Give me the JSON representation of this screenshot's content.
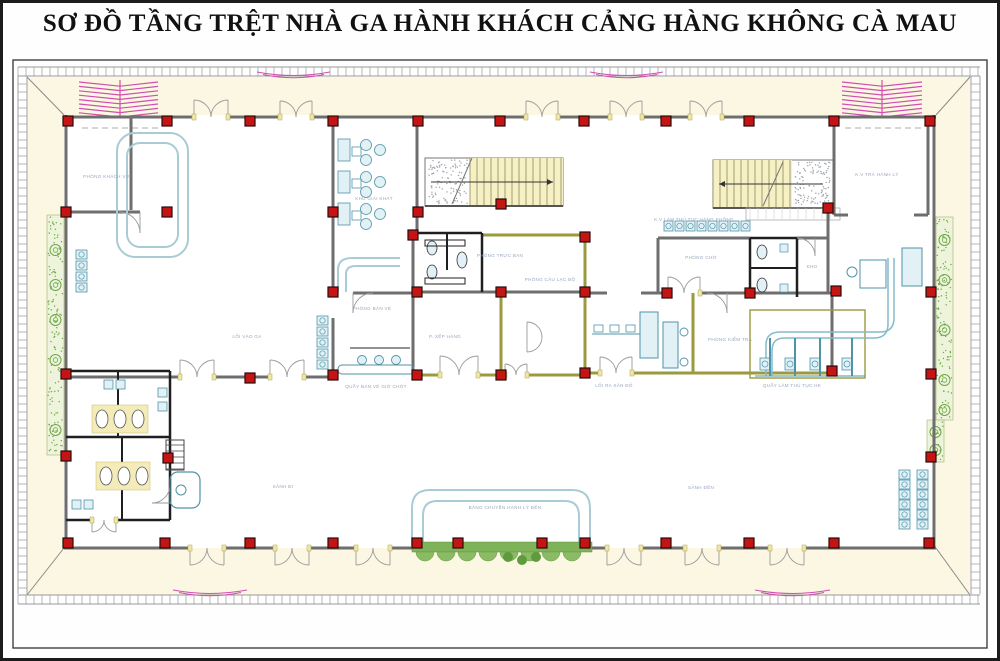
{
  "title": "SƠ ĐỒ TẦNG TRỆT NHÀ GA HÀNH KHÁCH CẢNG HÀNG KHÔNG CÀ MAU",
  "plan": {
    "name": "ground-floor-plan-ca-mau-airport-terminal",
    "labels": {
      "vip": "PHÒNG KHÁCH VIP",
      "cafe": "KHU GIẢI KHÁT",
      "office1": "PHÒNG TRỰC BAN",
      "club": "PHÒNG CÂU LẠC BỘ",
      "ticket_office": "PHÒNG BÁN VÉ",
      "queue": "P. XẾP HÀNG",
      "ticket_counter": "QUẦY BÁN VÉ GIỜ CHÓT",
      "entry": "LỐI VÀO GA",
      "checkin_area": "K.V LÀM THỦ TỤC HÀNG KHÔNG",
      "waiting": "PHÒNG CHỜ",
      "kho": "KHO",
      "security": "PHÒNG KIỂM TRA",
      "exit_apron": "LỐI RA SÂN ĐỖ",
      "checkin_counter": "QUẦY LÀM THỦ TỤC HK",
      "baggage": "K.V TRẢ HÀNH LÝ",
      "dep_lobby": "SẢNH ĐI",
      "carousel": "BĂNG CHUYỀN HÀNH LÝ ĐẾN",
      "arr_lobby": "SẢNH ĐẾN"
    },
    "colors": {
      "wall_grey": "#6e6e6e",
      "wall_dark": "#1f1f1f",
      "wall_olive": "#9a9a3e",
      "column_red": "#c41414",
      "column_edge": "#2a0a0a",
      "stair_fill": "#f6f0c4",
      "stair_line": "#8a8a5a",
      "furniture_blue": "#4f93a8",
      "furniture_fill": "#e2f1f6",
      "loop_blue": "#a9ccd4",
      "planter_green": "#6aa844",
      "planter_fill": "#eef3dc",
      "hedge_green": "#7fb35a",
      "hedge_edge": "#5a8f3c",
      "ramp_pink": "#cf4fae",
      "cream": "#fbf7e3",
      "frame": "#343434",
      "tick": "#9a9a9a",
      "label": "#98a6bd",
      "door": "#9a9a9a",
      "jamb_fill": "#efe6ac",
      "jamb_edge": "#b5a84a",
      "speckle": "#9aa0a6"
    }
  }
}
